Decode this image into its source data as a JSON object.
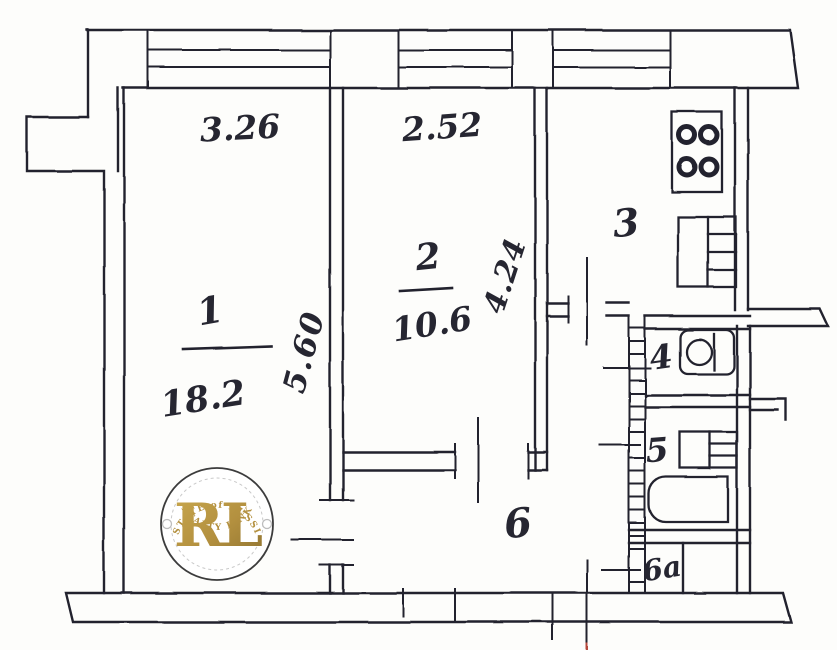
{
  "floor_plan": {
    "dimension_labels": {
      "room1_width": "3.26",
      "room2_width": "2.52",
      "room1_depth": "5.60",
      "room2_depth": "4.24"
    },
    "room_labels": {
      "room1": {
        "number": "1",
        "area": "18.2"
      },
      "room2": {
        "number": "2",
        "area": "10.6"
      },
      "kitchen": {
        "number": "3"
      },
      "wc": {
        "number": "4"
      },
      "bathroom": {
        "number": "5"
      },
      "hallway": {
        "number": "6"
      },
      "closet": {
        "number": "6a"
      }
    },
    "watermark": {
      "arc_top": "ESTATE of RUSSIA",
      "monogram": "RL",
      "arc_bottom": "REALTY LINK",
      "gold_color": "#b3903f"
    },
    "ink_color": "#23232e"
  }
}
